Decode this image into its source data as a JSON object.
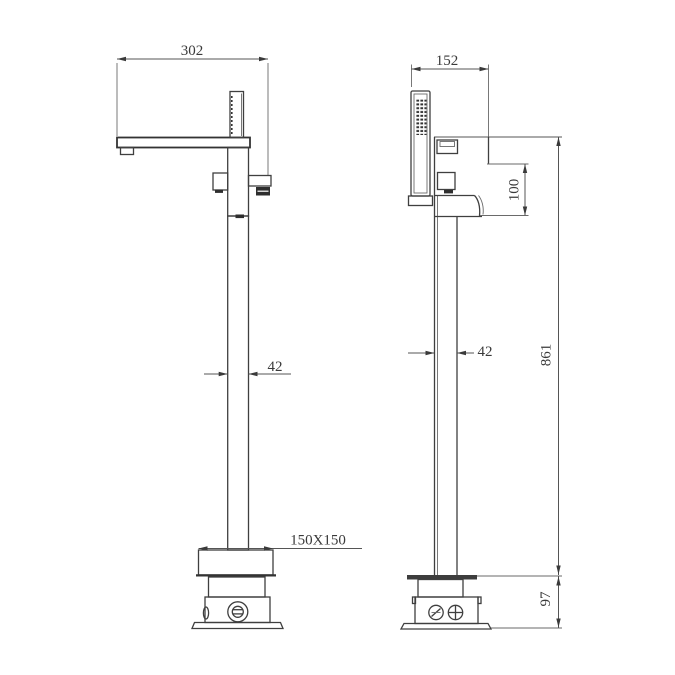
{
  "page": {
    "background": "#ffffff",
    "line_color": "#3f3f3f",
    "text_color": "#3a3a3a"
  },
  "drawing": {
    "dims": {
      "front_spout_reach": "302",
      "front_column_width": "42",
      "front_base_plate": "150X150",
      "side_handshower_offset": "152",
      "side_body_drop": "100",
      "side_column_width": "42",
      "side_height_above_floor": "861",
      "side_below_floor_depth": "97"
    }
  }
}
